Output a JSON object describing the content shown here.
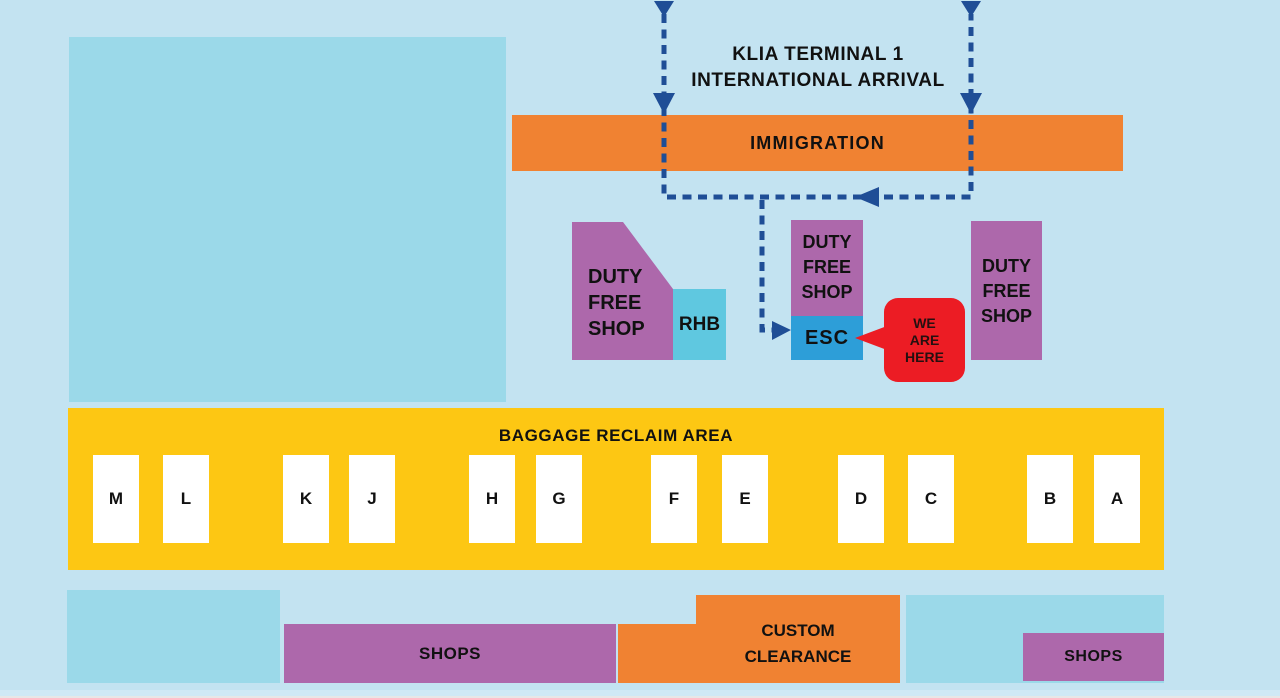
{
  "colors": {
    "background": "#c3e3f1",
    "area_blue": "#9bd9e9",
    "orange": "#f08232",
    "purple": "#ad68ab",
    "yellow": "#fdc713",
    "rhb_cyan": "#5fc8e0",
    "esc_blue": "#2d9ed8",
    "marker_red": "#ec1c24",
    "route_navy": "#1f4e96",
    "text_black": "#111111"
  },
  "header": {
    "title_line1": "KLIA TERMINAL 1",
    "title_line2": "INTERNATIONAL ARRIVAL"
  },
  "immigration": {
    "label": "IMMIGRATION"
  },
  "duty_free": {
    "lines": [
      "DUTY",
      "FREE",
      "SHOP"
    ]
  },
  "rhb": {
    "label": "RHB"
  },
  "esc": {
    "label": "ESC"
  },
  "we_are_here": {
    "lines": [
      "WE",
      "ARE",
      "HERE"
    ]
  },
  "baggage": {
    "title": "BAGGAGE RECLAIM AREA",
    "belts": [
      "M",
      "L",
      "K",
      "J",
      "H",
      "G",
      "F",
      "E",
      "D",
      "C",
      "B",
      "A"
    ]
  },
  "bottom": {
    "shops_left_label": "SHOPS",
    "custom_clearance_lines": [
      "CUSTOM",
      "CLEARANCE"
    ],
    "shops_right_label": "SHOPS"
  }
}
